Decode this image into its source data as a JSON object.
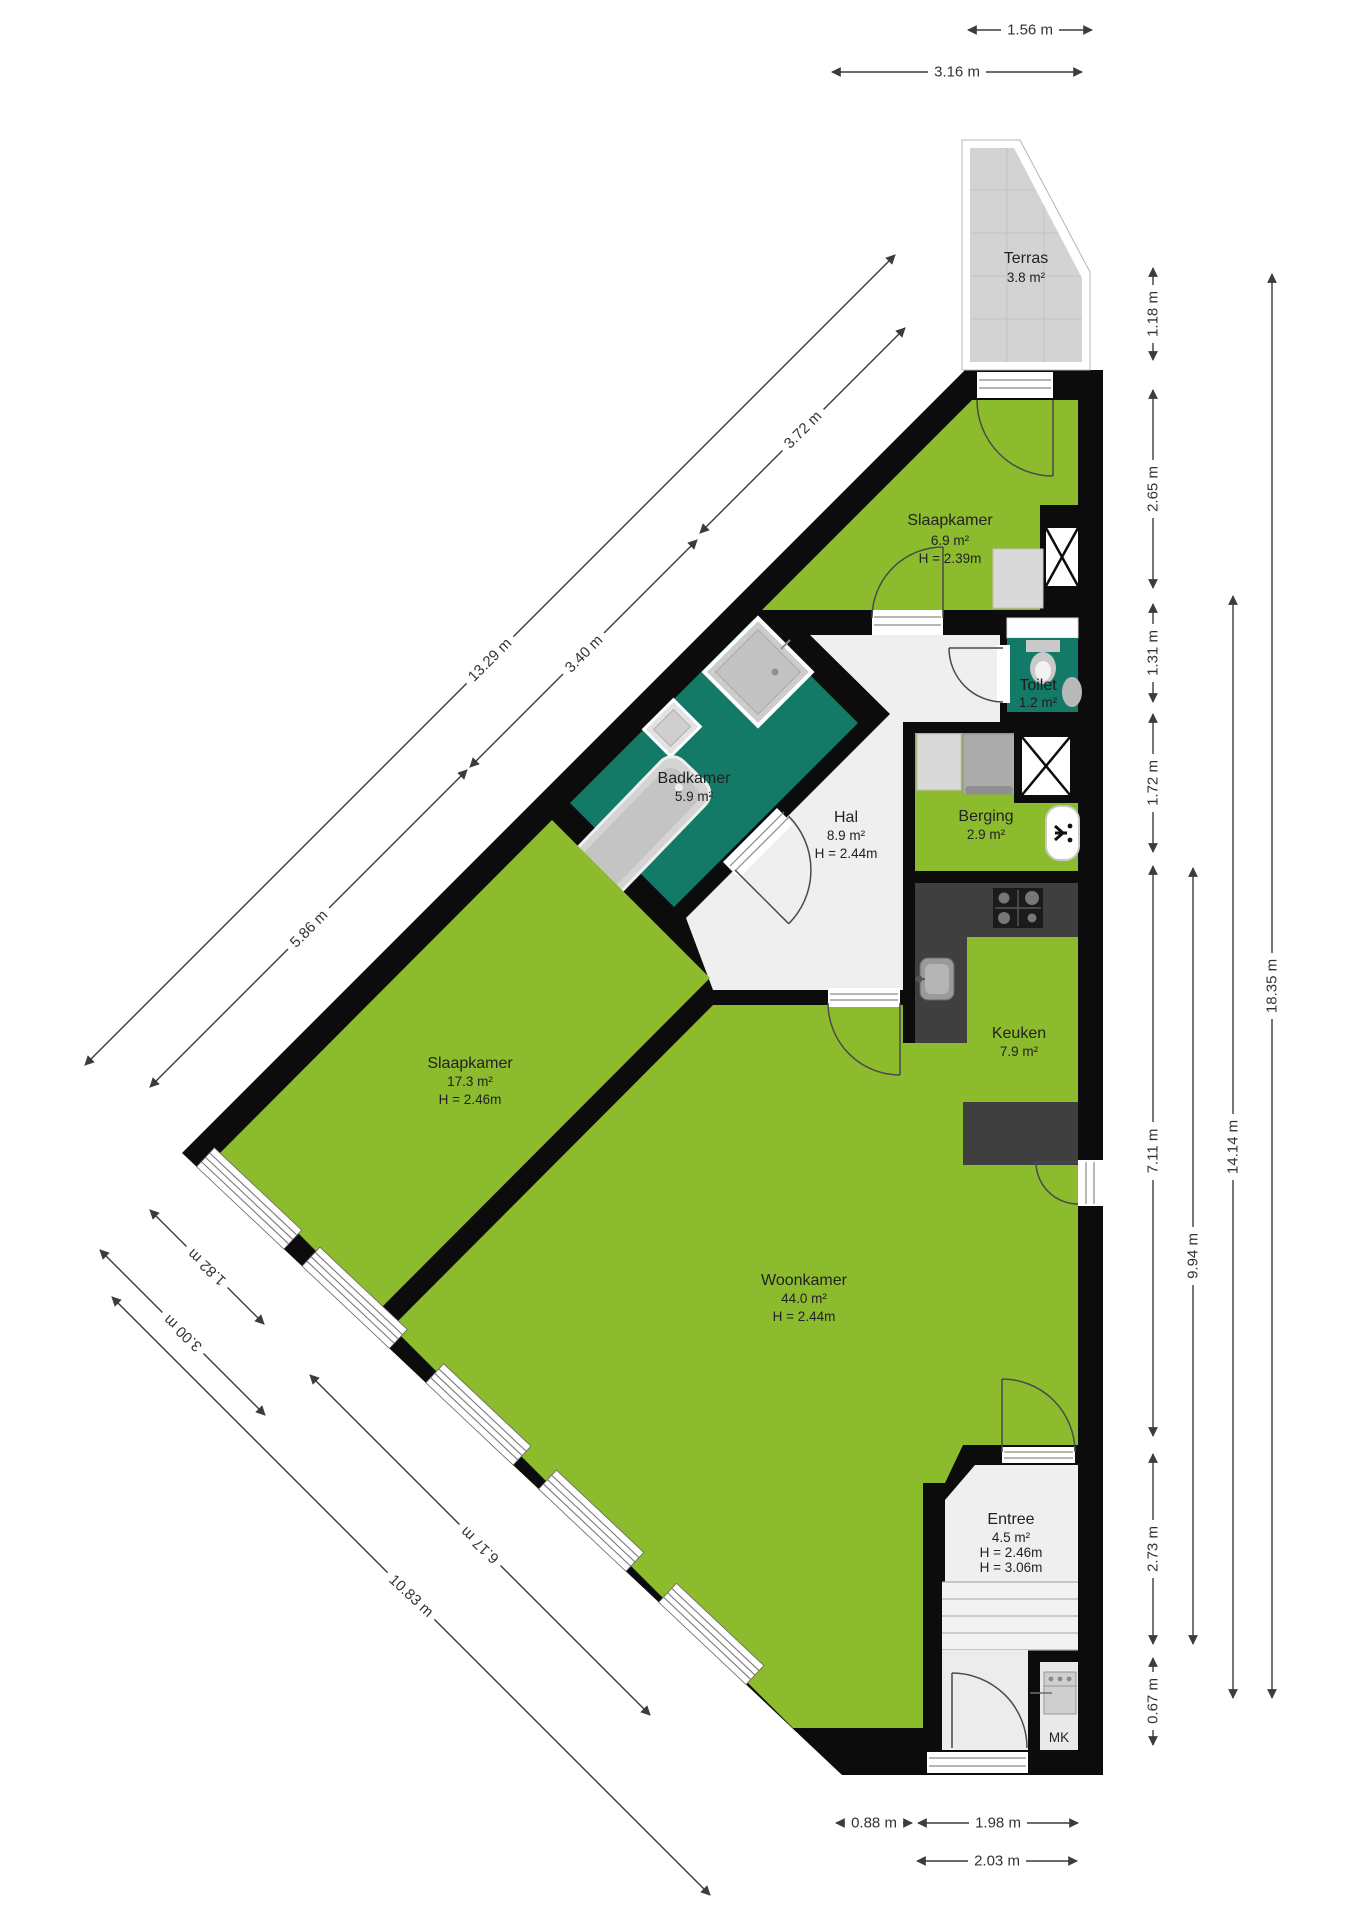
{
  "plan": {
    "rooms": {
      "terras": {
        "name": "Terras",
        "area": "3.8 m²"
      },
      "slaapkamer_klein": {
        "name": "Slaapkamer",
        "area": "6.9 m²",
        "height": "H = 2.39m"
      },
      "toilet": {
        "name": "Toilet",
        "area": "1.2 m²"
      },
      "badkamer": {
        "name": "Badkamer",
        "area": "5.9 m²"
      },
      "hal": {
        "name": "Hal",
        "area": "8.9 m²",
        "height": "H = 2.44m"
      },
      "berging": {
        "name": "Berging",
        "area": "2.9 m²"
      },
      "keuken": {
        "name": "Keuken",
        "area": "7.9 m²"
      },
      "slaapkamer_groot": {
        "name": "Slaapkamer",
        "area": "17.3 m²",
        "height": "H = 2.46m"
      },
      "woonkamer": {
        "name": "Woonkamer",
        "area": "44.0 m²",
        "height": "H = 2.44m"
      },
      "entree": {
        "name": "Entree",
        "area": "4.5 m²",
        "height_1": "H = 2.46m",
        "height_2": "H = 3.06m"
      },
      "meterkast": {
        "label": "MK"
      }
    },
    "dimensions": {
      "top": [
        "1.56 m",
        "3.16 m"
      ],
      "right_inner": [
        "1.18 m",
        "2.65 m",
        "1.31 m",
        "1.72 m",
        "7.11 m",
        "2.73 m",
        "0.67 m"
      ],
      "right_mid": "9.94 m",
      "right_outer": "14.14 m",
      "right_total": "18.35 m",
      "bottom": [
        "0.88 m",
        "1.98 m",
        "2.03 m"
      ],
      "diagonal_top": [
        "3.72 m",
        "3.40 m",
        "5.86 m",
        "13.29 m"
      ],
      "diagonal_bottom": [
        "1.82 m",
        "3.00 m",
        "6.17 m",
        "10.83 m"
      ]
    },
    "colors": {
      "floor": "#8cbb2e",
      "wet_room": "#137a68",
      "hall": "#efefef",
      "terrace": "#d3d3d3",
      "wall": "#0c0c0c",
      "counter": "#3f3f3f"
    }
  }
}
